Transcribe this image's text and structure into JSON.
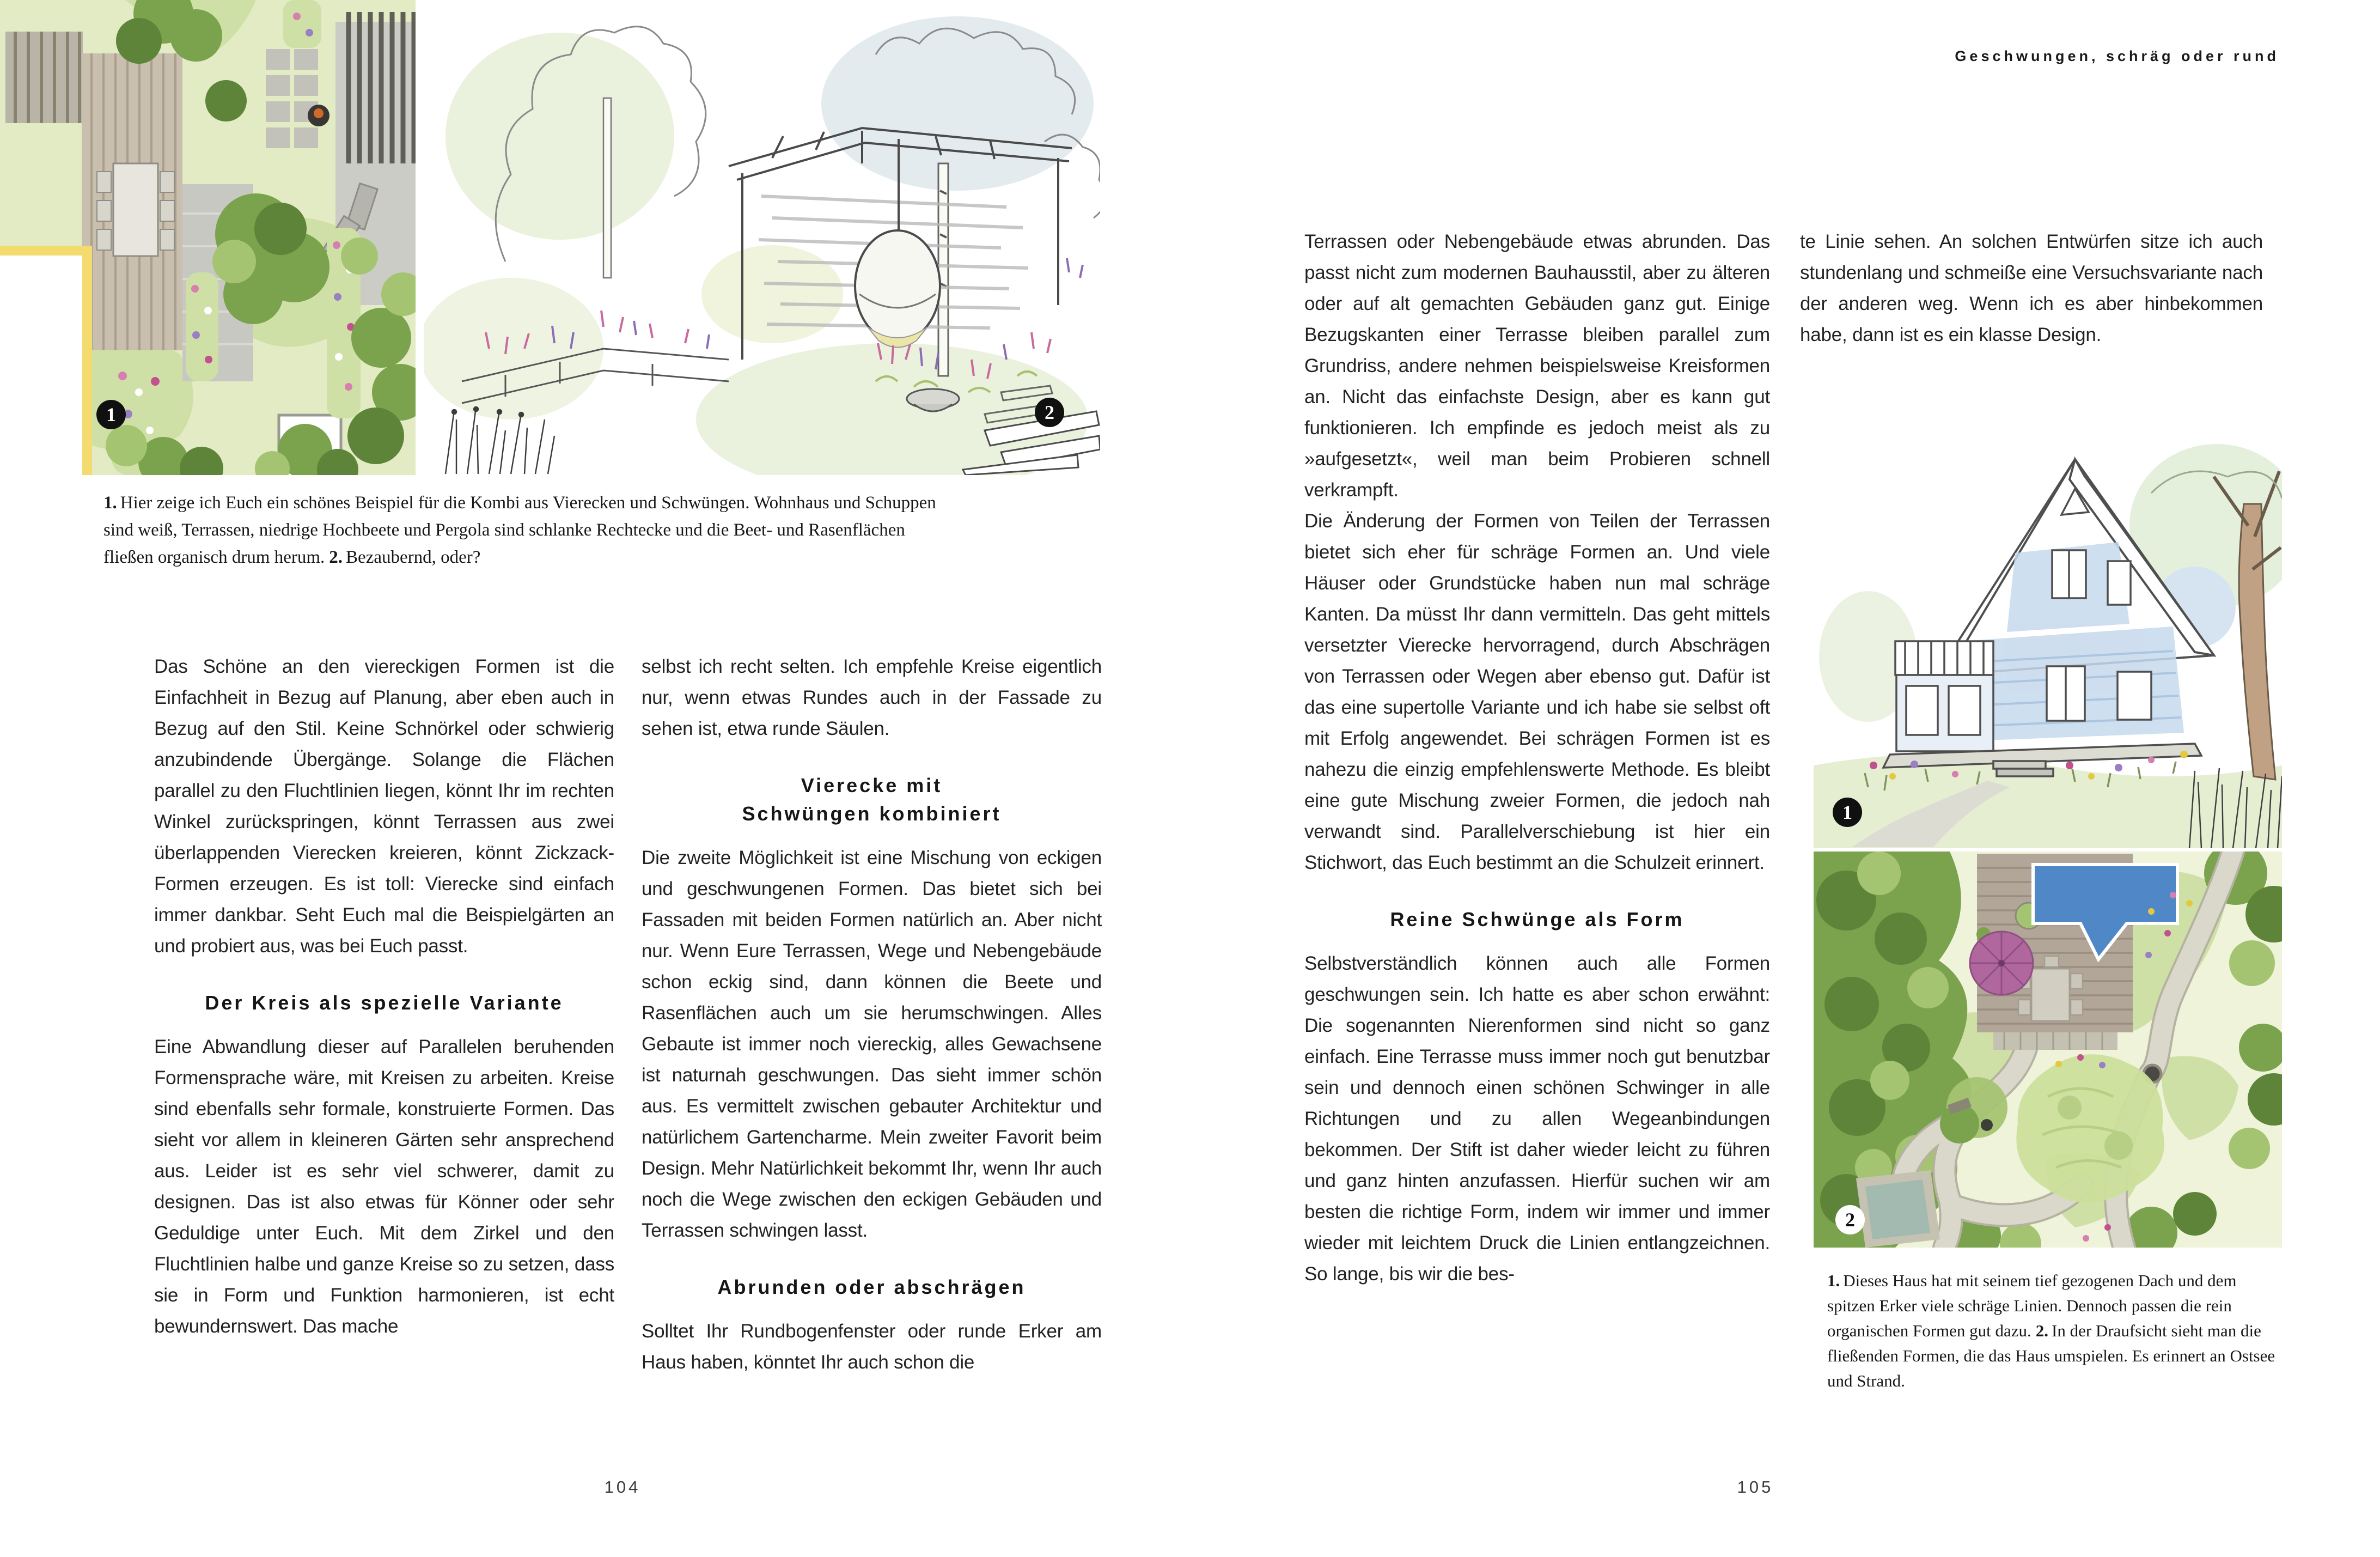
{
  "book": {
    "running_head": "Geschwungen, schräg oder rund",
    "page_number_left": "104",
    "page_number_right": "105"
  },
  "left_page": {
    "figures": {
      "plan_marker": "1",
      "sketch_marker": "2"
    },
    "caption": {
      "num1": "1.",
      "text1": "Hier zeige ich Euch ein schönes Beispiel für die Kombi aus Vierecken und Schwüngen. Wohnhaus und Schuppen sind weiß, Terrassen, niedrige Hochbeete und Pergola sind schlanke Rechtecke und die Beet- und Rasenflächen fließen organisch drum herum.",
      "num2": "2.",
      "text2": "Bezaubernd, oder?"
    },
    "column1": {
      "para1": "Das Schöne an den viereckigen Formen ist die Einfachheit in Bezug auf Planung, aber eben auch in Bezug auf den Stil. Keine Schnörkel oder schwierig anzubindende Übergänge. Solange die Flächen parallel zu den Fluchtlinien liegen, könnt Ihr im rechten Winkel zurückspringen, könnt Terrassen aus zwei überlappenden Vierecken kreieren, könnt Zickzack-Formen erzeugen. Es ist toll: Vierecke sind einfach immer dankbar. Seht Euch mal die Beispielgärten an und probiert aus, was bei Euch passt.",
      "heading1": "Der Kreis als spezielle Variante",
      "para2": "Eine Abwandlung dieser auf Parallelen beruhenden Formensprache wäre, mit Kreisen zu arbeiten. Kreise sind ebenfalls sehr formale, konstruierte Formen. Das sieht vor allem in kleineren Gärten sehr ansprechend aus. Leider ist es sehr viel schwerer, damit zu designen. Das ist also etwas für Könner oder sehr Geduldige unter Euch. Mit dem Zirkel und den Fluchtlinien halbe und ganze Kreise so zu setzen, dass sie in Form und Funktion harmonieren, ist echt bewundernswert. Das mache"
    },
    "column2": {
      "para1": "selbst ich recht selten. Ich empfehle Kreise eigentlich nur, wenn etwas Rundes auch in der Fassade zu sehen ist, etwa runde Säulen.",
      "heading1_line1": "Vierecke mit",
      "heading1_line2": "Schwüngen kombiniert",
      "para2": "Die zweite Möglichkeit ist eine Mischung von eckigen und geschwungenen Formen. Das bietet sich bei Fassaden mit beiden Formen natürlich an. Aber nicht nur. Wenn Eure Terrassen, Wege und Nebengebäude schon eckig sind, dann können die Beete und Rasenflächen auch um sie herumschwingen. Alles Gebaute ist immer noch viereckig, alles Gewachsene ist naturnah geschwungen. Das sieht immer schön aus. Es vermittelt zwischen gebauter Architektur und natürlichem Gartencharme. Mein zweiter Favorit beim Design. Mehr Natürlichkeit bekommt Ihr, wenn Ihr auch noch die Wege zwischen den eckigen Gebäuden und Terrassen schwingen lasst.",
      "heading2": "Abrunden oder abschrägen",
      "para3": "Solltet Ihr Rundbogenfenster oder runde Erker am Haus haben, könntet Ihr auch schon die"
    }
  },
  "right_page": {
    "figures": {
      "sketch_marker": "1",
      "plan_marker": "2"
    },
    "column1": {
      "para1": "Terrassen oder Nebengebäude etwas abrunden. Das passt nicht zum modernen Bauhausstil, aber zu älteren oder auf alt gemachten Gebäuden ganz gut. Einige Bezugskanten einer Terrasse bleiben parallel zum Grundriss, andere nehmen beispielsweise Kreisformen an. Nicht das einfachste Design, aber es kann gut funktionieren. Ich empfinde es jedoch meist als zu »aufgesetzt«, weil man beim Probieren schnell verkrampft.",
      "para2": "Die Änderung der Formen von Teilen der Terrassen bietet sich eher für schräge Formen an. Und viele Häuser oder Grundstücke haben nun mal schräge Kanten. Da müsst Ihr dann vermitteln. Das geht mittels versetzter Vierecke hervorragend, durch Abschrägen von Terrassen oder Wegen aber ebenso gut. Dafür ist das eine supertolle Variante und ich habe sie selbst oft mit Erfolg angewendet. Bei schrägen Formen ist es nahezu die einzig empfehlenswerte Methode. Es bleibt eine gute Mischung zweier Formen, die jedoch nah verwandt sind. Parallelverschiebung ist hier ein Stichwort, das Euch bestimmt an die Schulzeit erinnert.",
      "heading1": "Reine Schwünge als Form",
      "para3": "Selbstverständlich können auch alle Formen geschwungen sein. Ich hatte es aber schon erwähnt: Die sogenannten Nierenformen sind nicht so ganz einfach. Eine Terrasse muss immer noch gut benutzbar sein und dennoch einen schönen Schwinger in alle Richtungen und zu allen Wegeanbindungen bekommen. Der Stift ist daher wieder leicht zu führen und ganz hinten anzufassen. Hierfür suchen wir am besten die richtige Form, indem wir immer und immer wieder mit leichtem Druck die Linien entlangzeichnen. So lange, bis wir die bes-"
    },
    "column2": {
      "para1": "te Linie sehen. An solchen Entwürfen sitze ich auch stundenlang und schmeiße eine Versuchsvariante nach der anderen weg. Wenn ich es aber hinbekommen habe, dann ist es ein klasse Design."
    },
    "caption": {
      "num1": "1.",
      "text1": "Dieses Haus hat mit seinem tief gezogenen Dach und dem spitzen Erker viele schräge Linien. Dennoch passen die rein organischen Formen gut dazu.",
      "num2": "2.",
      "text2": "In der Draufsicht sieht man die fließenden Formen, die das Haus umspielen. Es erinnert an Ostsee und Strand."
    }
  },
  "colors": {
    "lawn_green": "#e2ebc4",
    "lawn_cream": "#eef3da",
    "garden_green_mid": "#cfe0a6",
    "tree_green_dark": "#5d8438",
    "tree_green": "#7ba24c",
    "tree_green_light": "#a5c472",
    "canopy_pale": "#cbdf9b",
    "path_gray": "#dad8ca",
    "terrace_gray": "#c8c8c2",
    "deck_wood": "#b1a698",
    "deck_wood_left": "#c9bfae",
    "house_yellow": "#f3db70",
    "flag_blue": "#4f87c7",
    "umbrella_purple": "#b0679d",
    "pond_teal": "#a3bab0",
    "wash_blue": "#e3ebee",
    "wash_green": "#eaf1dc",
    "house_wash_blue": "#c6d9ec",
    "flower_pink": "#d77fae",
    "flower_magenta": "#c2518d",
    "flower_purple": "#9b7fc4",
    "flower_yellow": "#e3c93f",
    "sketch_line": "#5a5a5a"
  }
}
